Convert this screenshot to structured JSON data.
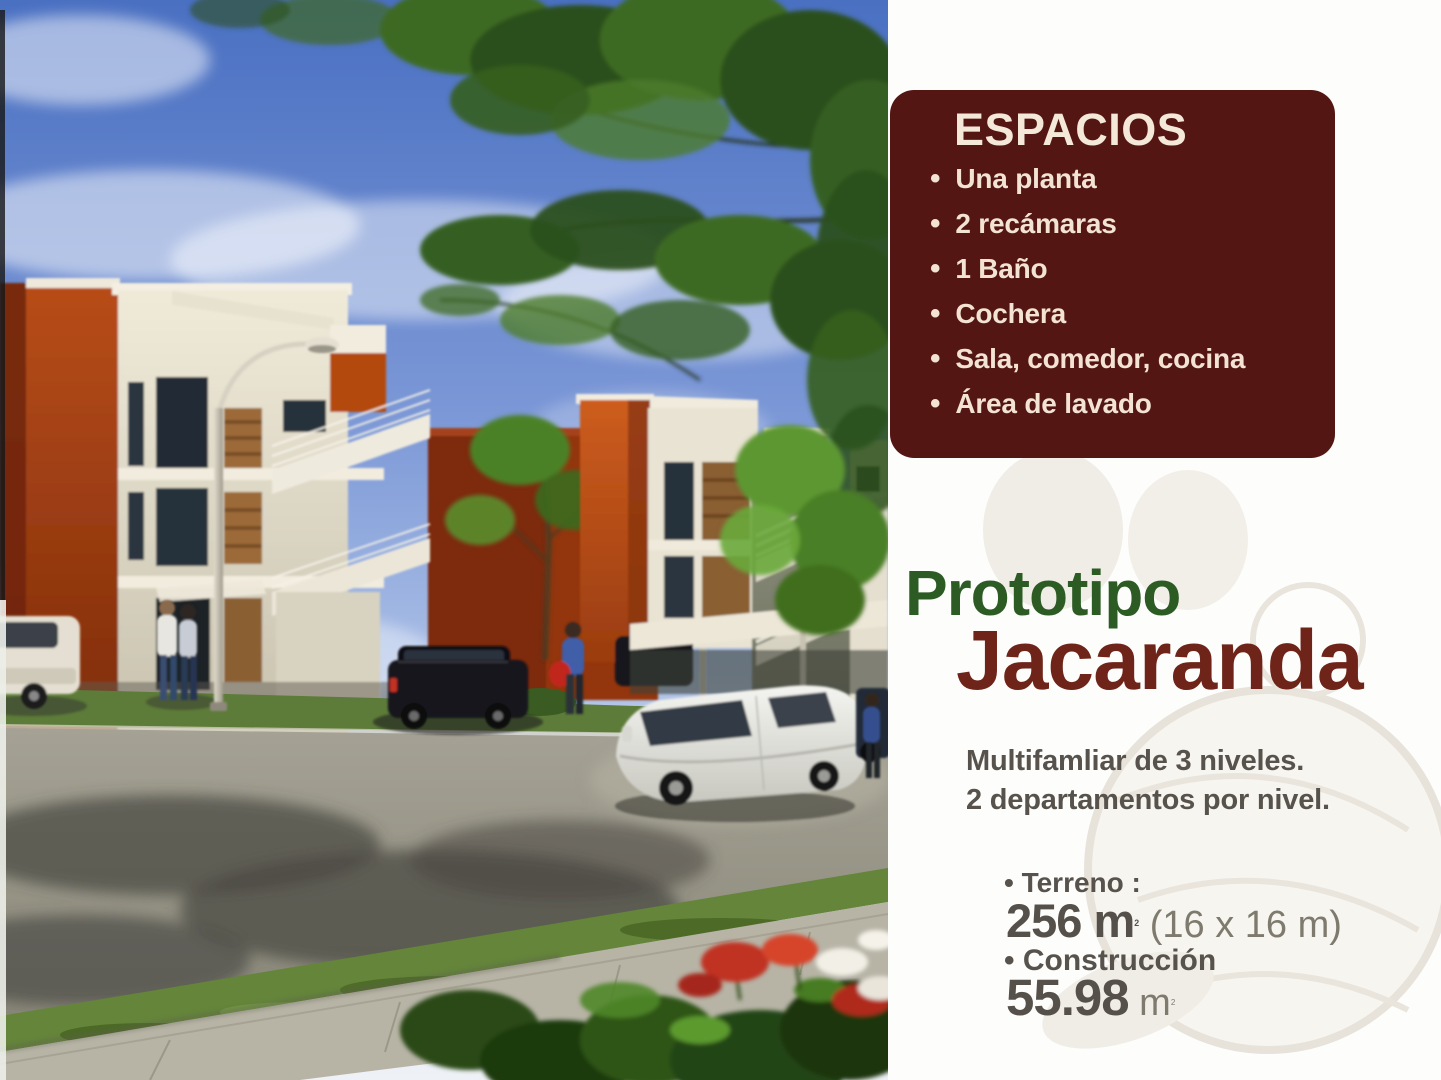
{
  "panel": {
    "espacios_box": {
      "title": "ESPACIOS",
      "bullet": "•",
      "items": [
        "Una planta",
        "2 recámaras",
        "1 Baño",
        "Cochera",
        "Sala, comedor, cocina",
        "Área de lavado"
      ]
    },
    "title": {
      "line1": "Prototipo",
      "line2": "Jacaranda"
    },
    "description": {
      "line1": "Multifamliar de 3 niveles.",
      "line2": "2 departamentos por nivel."
    },
    "specs": {
      "terreno_label": "• Terreno :",
      "terreno_value_main": "256 m",
      "terreno_value_sup": "2",
      "terreno_value_extra": " (16 x 16 m)",
      "construccion_label": "• Construcción",
      "construccion_value_main": "55.98",
      "construccion_unit": " m",
      "construccion_sup": "2"
    }
  },
  "colors": {
    "espacios_box_bg": "#531613",
    "espacios_text": "#f2e3d2",
    "title_green": "#2c5b24",
    "title_maroon": "#6e2418",
    "body_text_gray": "#57534c",
    "accent_orange_wall": "#b84d18",
    "sky_blue": "#4a70c2"
  }
}
